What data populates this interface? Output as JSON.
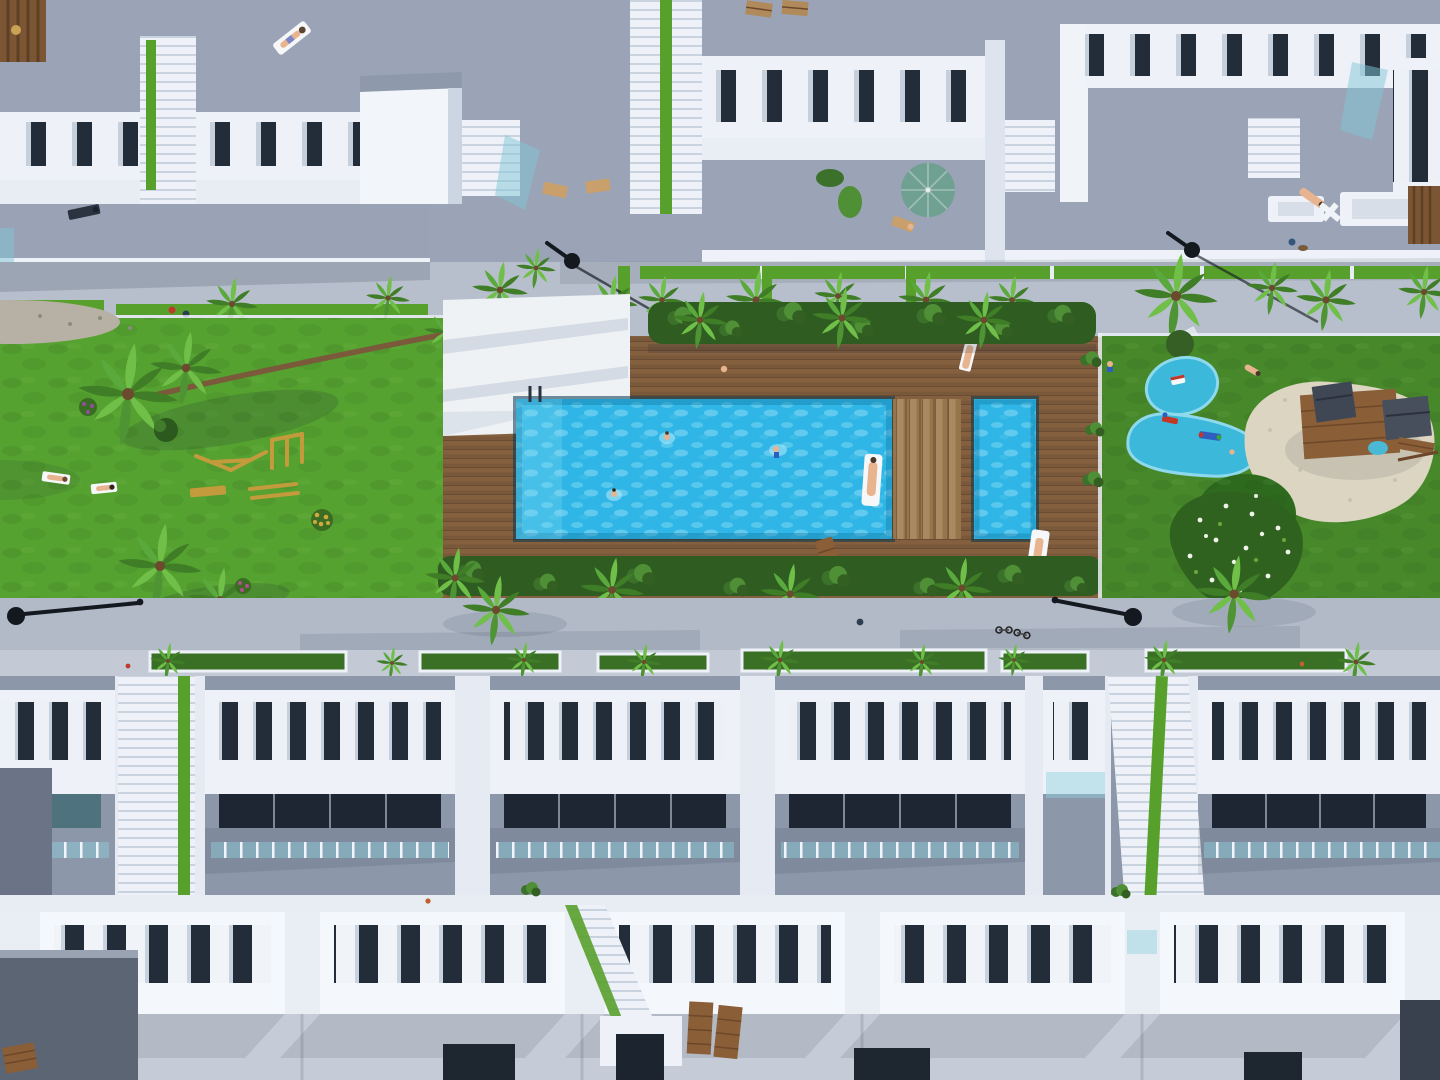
{
  "scene": {
    "type": "aerial-3d-architectural-render",
    "description": "Top-down bird's-eye render of a white residential townhouse complex with a central communal strip: lawns, wooden pool deck with a large rectangular pool and kids' pool, outdoor gym, splash pads, sand playground, palm trees, walkways with lamps, and rows of rooftop terraces with white balustrades.",
    "areas": [
      {
        "name": "top-buildings",
        "description": "Row of white apartment blocks with rooftop terraces, balustrade railings, stair alleys with green strips, sun loungers and a teal parasol"
      },
      {
        "name": "upper-walkway",
        "description": "Light grey pedestrian promenade with lawn strips, young palms, street lamps and walking residents"
      },
      {
        "name": "left-lawn",
        "description": "Bright lawn with leaning palm, outdoor wooden gym equipment, sunbathers and flower tufts"
      },
      {
        "name": "pool-deck",
        "description": "Wooden plank deck with main swimming pool, wide deck steps, kids' pool, loungers and swimmers"
      },
      {
        "name": "right-lawn",
        "description": "Lawn with two cyan splash pads with rocking toys, sand playground with timber play tower, green mat with red slide and a white-flowering shrub"
      },
      {
        "name": "lower-walkway",
        "description": "Grey path with two flat-viewed street lamps, parked bicycle, palms and planter boxes"
      },
      {
        "name": "bottom-terrace-row",
        "description": "Row of townhouse roof terraces: white pillar parapets, dark glazing, teal glass balustrades, two stair alleys with green strips"
      },
      {
        "name": "foreground-roofs",
        "description": "Closest row of roofs with white pillar parapets, pale tiled roofs, timber loungers and dark doorways"
      }
    ],
    "objects": {
      "swimmers": 3,
      "pool_float": 1,
      "parasols": 1,
      "street_lamps": 4,
      "palm_trees": 30,
      "splash_pads": 2,
      "playgrounds": 2,
      "stair_alleys": 6,
      "sun_loungers": 9,
      "people_walking": 10
    }
  },
  "colors": {
    "roof_gray": "#9aa4b6",
    "roof_light": "#c6ccd7",
    "walk_upper": "#b7bfcc",
    "walk_lower": "#b2bac8",
    "terrace_gray": "#8d97aa",
    "white_struct": "#eef2f8",
    "glass_dark": "#232c39",
    "lawn_bright": "#56a230",
    "lawn_deep": "#47882a",
    "deck_wood": "#84603f",
    "pool_water": "#2fb6e6",
    "pool_ripple": "#7fd9f2",
    "hedge_green": "#2e5c21",
    "palm_light": "#6fbf49",
    "palm_dark": "#3f7d27",
    "sand": "#dcd5c1",
    "splash_blue": "#3cb8da",
    "umbrella_teal": "#6fa091",
    "play_wood": "#8a5f38",
    "gym_wood": "#c49b3c",
    "slide_red": "#cf3526",
    "glass_teal": "#8fd0dd",
    "stair_green": "#58a02c",
    "sidewalk": "#c3cad6"
  }
}
